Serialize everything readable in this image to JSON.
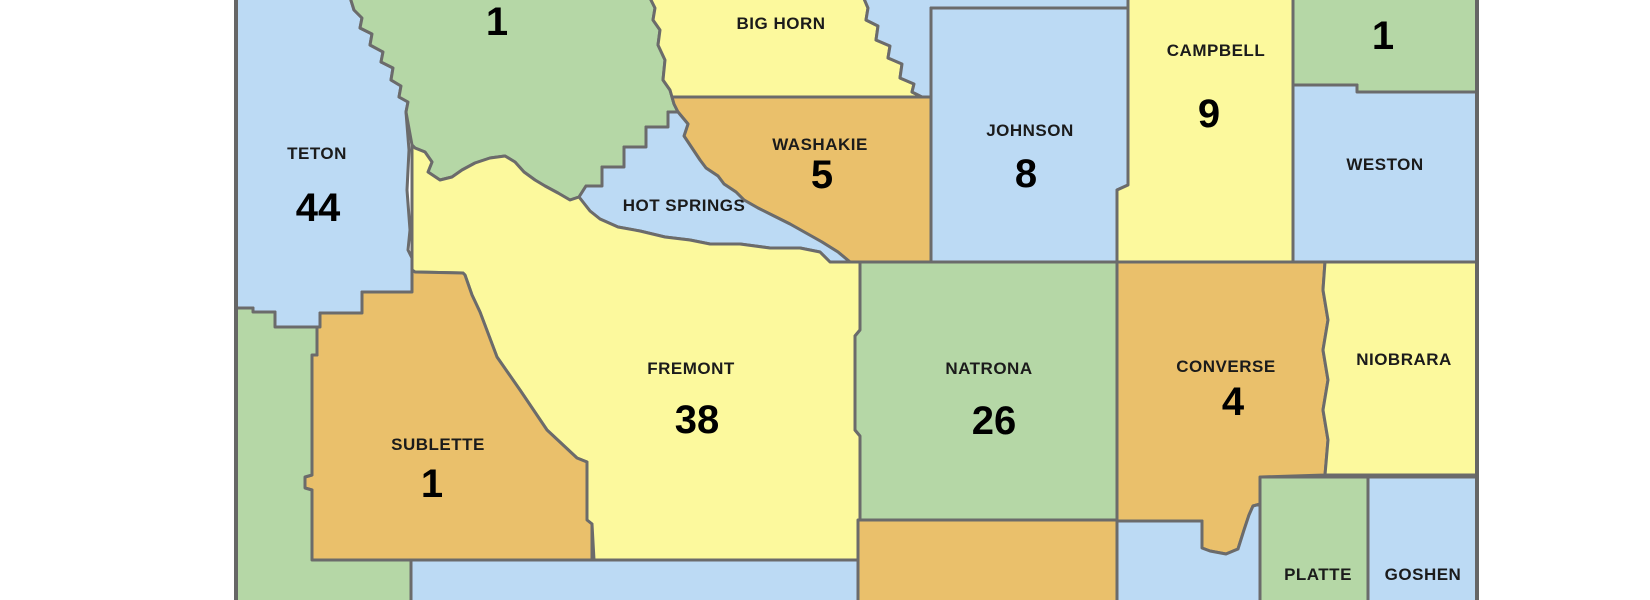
{
  "map": {
    "background": "#ffffff",
    "border_color": "#6b6b6b",
    "label_color": "#1b1b1b",
    "number_color": "#000000",
    "palette": {
      "blue": "#bcdaf4",
      "green": "#b5d7a6",
      "yellow": "#fcf99d",
      "orange": "#eac06b"
    },
    "counties": [
      {
        "id": "teton",
        "label": "TETON",
        "value": "44",
        "color": "blue"
      },
      {
        "id": "park",
        "label": "",
        "value": "1",
        "color": "green"
      },
      {
        "id": "big-horn",
        "label": "BIG HORN",
        "value": "",
        "color": "yellow"
      },
      {
        "id": "sheridan",
        "label": "",
        "value": "",
        "color": "blue"
      },
      {
        "id": "johnson",
        "label": "JOHNSON",
        "value": "8",
        "color": "blue"
      },
      {
        "id": "campbell",
        "label": "CAMPBELL",
        "value": "9",
        "color": "yellow"
      },
      {
        "id": "crook",
        "label": "",
        "value": "1",
        "color": "green"
      },
      {
        "id": "weston",
        "label": "WESTON",
        "value": "",
        "color": "blue"
      },
      {
        "id": "washakie",
        "label": "WASHAKIE",
        "value": "5",
        "color": "orange"
      },
      {
        "id": "hot-springs",
        "label": "HOT SPRINGS",
        "value": "",
        "color": "blue"
      },
      {
        "id": "fremont",
        "label": "FREMONT",
        "value": "38",
        "color": "yellow"
      },
      {
        "id": "natrona",
        "label": "NATRONA",
        "value": "26",
        "color": "green"
      },
      {
        "id": "converse",
        "label": "CONVERSE",
        "value": "4",
        "color": "orange"
      },
      {
        "id": "niobrara",
        "label": "NIOBRARA",
        "value": "",
        "color": "yellow"
      },
      {
        "id": "sublette",
        "label": "SUBLETTE",
        "value": "1",
        "color": "orange"
      },
      {
        "id": "lincoln",
        "label": "",
        "value": "",
        "color": "green"
      },
      {
        "id": "sweetwater",
        "label": "",
        "value": "",
        "color": "blue"
      },
      {
        "id": "carbon",
        "label": "",
        "value": "",
        "color": "orange"
      },
      {
        "id": "albany",
        "label": "",
        "value": "",
        "color": "blue"
      },
      {
        "id": "platte",
        "label": "PLATTE",
        "value": "",
        "color": "green"
      },
      {
        "id": "goshen",
        "label": "GOSHEN",
        "value": "",
        "color": "blue"
      }
    ]
  }
}
